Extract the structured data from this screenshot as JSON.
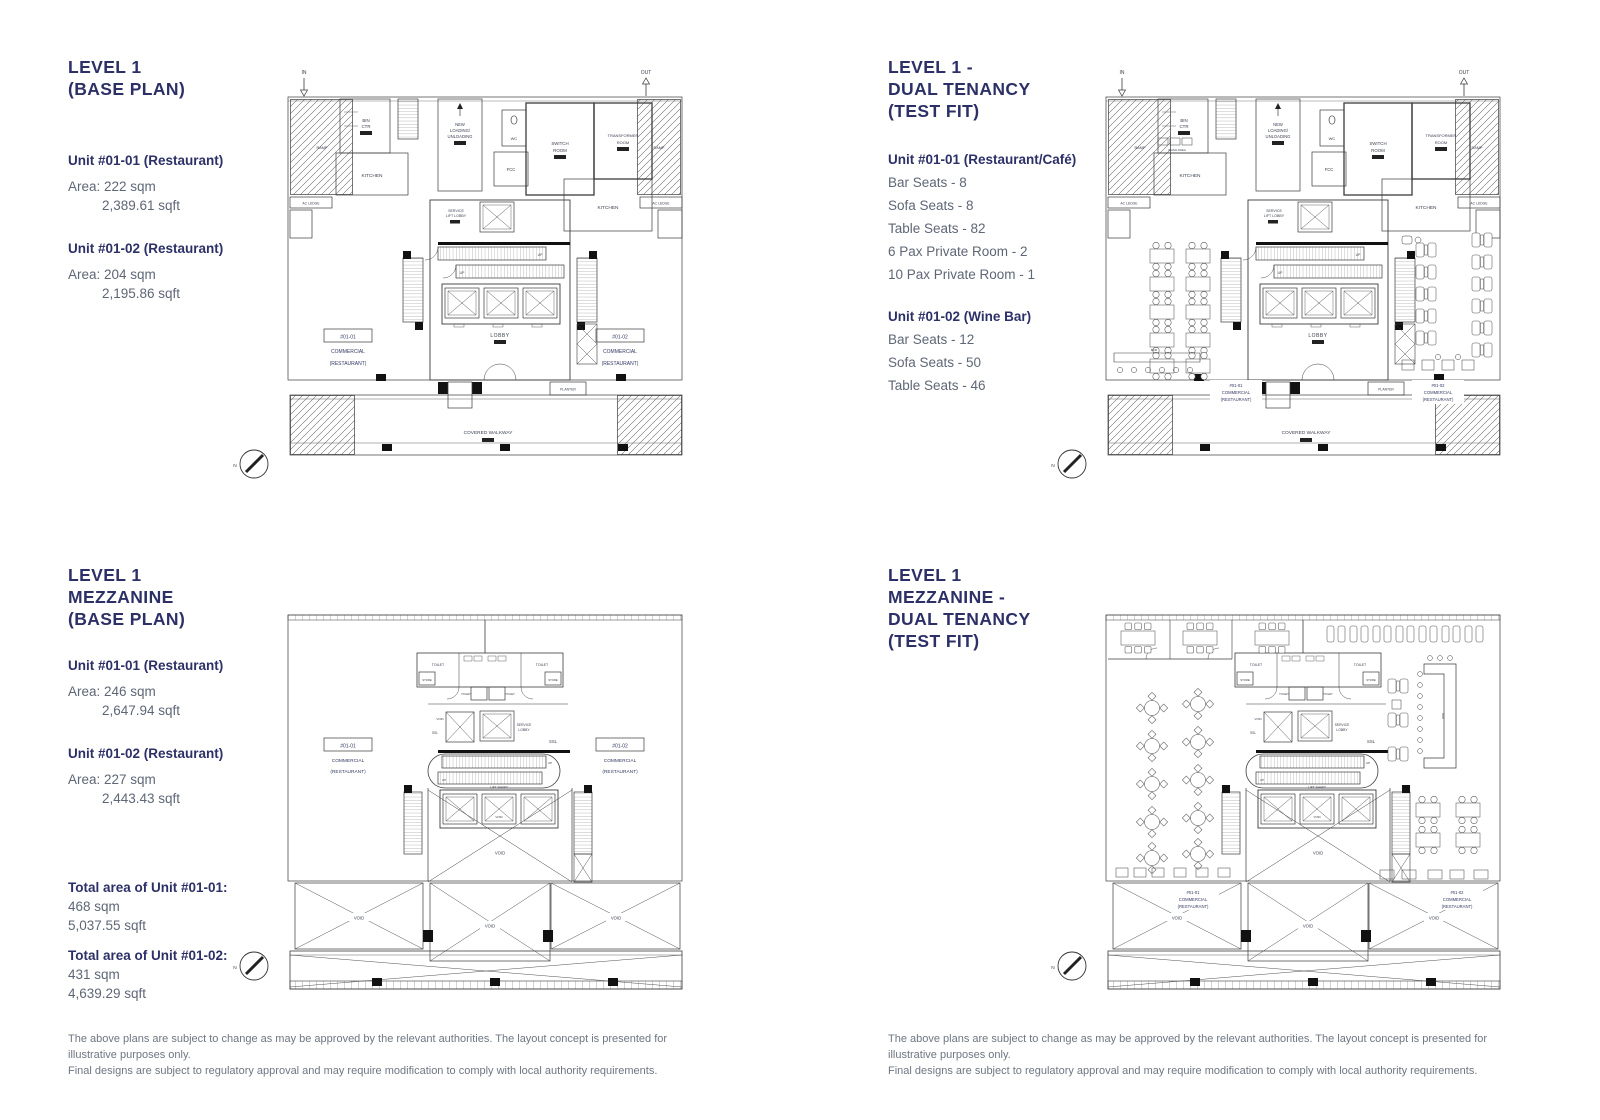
{
  "panels": {
    "level1_base": {
      "title": [
        "LEVEL 1",
        "(BASE PLAN)"
      ],
      "units": [
        {
          "name": "Unit #01-01 (Restaurant)",
          "sqm": "Area: 222 sqm",
          "sqft": "2,389.61 sqft"
        },
        {
          "name": "Unit #01-02 (Restaurant)",
          "sqm": "Area: 204 sqm",
          "sqft": "2,195.86 sqft"
        }
      ]
    },
    "level1_testfit": {
      "title": [
        "LEVEL 1 -",
        "DUAL TENANCY",
        "(TEST FIT)"
      ],
      "units": [
        {
          "name": "Unit #01-01 (Restaurant/Café)",
          "items": [
            "Bar Seats - 8",
            "Sofa Seats - 8",
            "Table Seats - 82",
            "6 Pax Private Room - 2",
            "10 Pax Private Room - 1"
          ]
        },
        {
          "name": "Unit #01-02 (Wine Bar)",
          "items": [
            "Bar Seats - 12",
            "Sofa Seats - 50",
            "Table Seats - 46"
          ]
        }
      ]
    },
    "mezz_base": {
      "title": [
        "LEVEL 1",
        "MEZZANINE",
        "(BASE PLAN)"
      ],
      "units": [
        {
          "name": "Unit #01-01 (Restaurant)",
          "sqm": "Area: 246 sqm",
          "sqft": "2,647.94 sqft"
        },
        {
          "name": "Unit #01-02 (Restaurant)",
          "sqm": "Area: 227 sqm",
          "sqft": "2,443.43 sqft"
        }
      ],
      "totals": [
        {
          "name": "Total area of Unit #01-01:",
          "sqm": "468 sqm",
          "sqft": "5,037.55 sqft"
        },
        {
          "name": "Total area of Unit #01-02:",
          "sqm": "431 sqm",
          "sqft": "4,639.29 sqft"
        }
      ]
    },
    "mezz_testfit": {
      "title": [
        "LEVEL 1",
        "MEZZANINE -",
        "DUAL TENANCY",
        "(TEST FIT)"
      ]
    }
  },
  "disclaimer": {
    "line1": "The above plans are subject to change as may be approved by the relevant authorities. The layout concept is presented for illustrative purposes only.",
    "line2": "Final designs are subject to regulatory approval and may require modification to comply with local authority requirements."
  },
  "labels": {
    "in": "IN",
    "out": "OUT",
    "ramp": "RAMP",
    "bin": "BIN",
    "ctr": "CTR",
    "kitchen": "KITCHEN",
    "new": "NEW",
    "loading": "LOADING/",
    "unloading": "UNLOADING",
    "wc": "WC",
    "fcc": "FCC",
    "switch": "SWITCH",
    "room": "ROOM",
    "transformer": "TRANSFORMER",
    "ac_ledge": "AC LEDGE",
    "service": "SERVICE",
    "lift_lobby": "LIFT LOBBY",
    "lobby": "LOBBY",
    "up": "UP",
    "unit1": "#01-01",
    "unit2": "#01-02",
    "commercial": "COMMERCIAL",
    "restaurant": "(RESTAURANT)",
    "covered_walkway": "COVERED WALKWAY",
    "planter": "PLANTER",
    "north": "N",
    "toilet": "TOILET",
    "store": "STORE",
    "ssl": "SSL",
    "lift_shaft": "LIFT SHAFT",
    "void": "VOID",
    "wash_area": "WASH AREA",
    "bar": "BAR"
  },
  "colors": {
    "heading": "#2c3067",
    "body": "#5e6776",
    "disclaimer": "#6e7683",
    "linework": "#3c3c3c"
  }
}
